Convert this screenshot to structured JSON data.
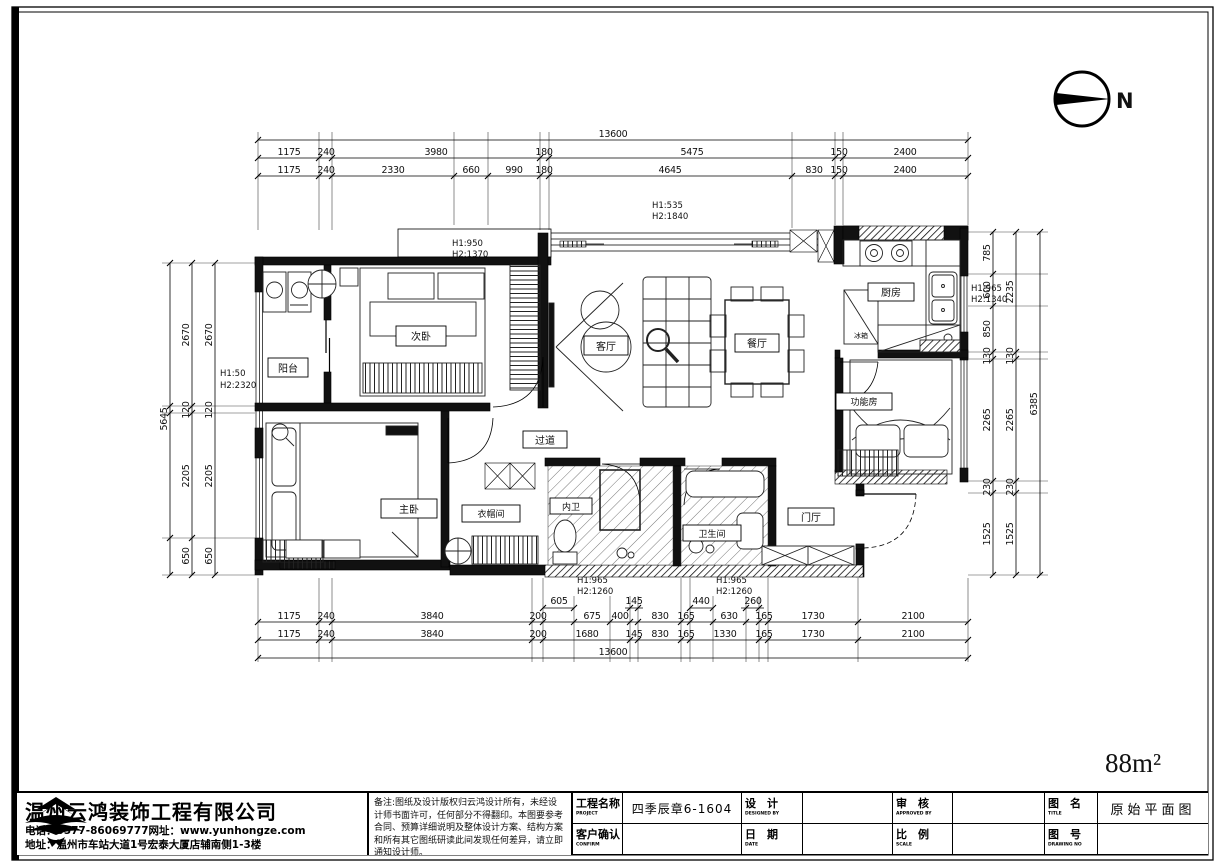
{
  "meta": {
    "area_label": "88m²",
    "north_label": "N"
  },
  "rooms": {
    "balcony": "阳台",
    "bedroom2": "次卧",
    "living": "客厅",
    "dining": "餐厅",
    "kitchen": "厨房",
    "fridge": "冰箱",
    "function_room": "功能房",
    "corridor": "过道",
    "master": "主卧",
    "cloakroom": "衣帽间",
    "master_bath": "内卫",
    "bathroom": "卫生间",
    "foyer": "门厅"
  },
  "h_notes": {
    "top_center": {
      "l1": "H1:535",
      "l2": "H2:1840"
    },
    "bed2_bay": {
      "l1": "H1:950",
      "l2": "H2:1370"
    },
    "left_wall": {
      "l1": "H1:50",
      "l2": "H2:2320"
    },
    "kitchen_win": {
      "l1": "H1:965",
      "l2": "H2:1340"
    },
    "bottom_a": {
      "l1": "H1:965",
      "l2": "H2:1260"
    },
    "bottom_b": {
      "l1": "H1:965",
      "l2": "H2:1260"
    }
  },
  "dims": {
    "top_total": "13600",
    "top_row2": [
      "1175",
      "240",
      "3980",
      "180",
      "5475",
      "150",
      "2400"
    ],
    "top_row3": [
      "1175",
      "240",
      "2330",
      "660",
      "990",
      "180",
      "4645",
      "830",
      "150",
      "2400"
    ],
    "bottom_raised": [
      "605",
      "145",
      "440",
      "260"
    ],
    "bottom_row1": [
      "1175",
      "240",
      "3840",
      "200",
      "675",
      "400",
      "830",
      "165",
      "630",
      "165",
      "1730",
      "2100"
    ],
    "bottom_row2": [
      "1175",
      "240",
      "3840",
      "200",
      "1680",
      "145",
      "830",
      "165",
      "1330",
      "165",
      "1730",
      "2100"
    ],
    "bottom_total": "13600",
    "left_col": [
      "2670",
      "120",
      "2205",
      "650"
    ],
    "left_total": "5645",
    "right_col1": [
      "785",
      "600",
      "850",
      "130",
      "2265",
      "230",
      "1525"
    ],
    "right_col2": [
      "2235",
      "130",
      "2265",
      "230",
      "1525"
    ],
    "right_total": "6385"
  },
  "titleblock": {
    "company": "温州云鸿装饰工程有限公司",
    "contact_phone": "电话：0577-86069777网址：www.yunhongze.com",
    "contact_addr": "地址：温州市车站大道1号宏泰大厦店辅南侧1-3楼",
    "notes": "备注:图纸及设计版权归云鸿设计所有，未经设计师书面许可，任何部分不得翻印。本图要参考合同、预算详细说明及整体设计方案、结构方案和所有其它图纸研读此间发现任何差异，请立即通知设计师。",
    "project_label": "工程名称",
    "project_label_en": "PROJECT",
    "project_value": "四季辰章6-1604",
    "confirm_label": "客户确认",
    "confirm_label_en": "CONFIRM",
    "design_label": "设　计",
    "design_label_en": "DESIGNED BY",
    "date_label": "日　期",
    "date_label_en": "DATE",
    "approve_label": "审　核",
    "approve_label_en": "APPROVED BY",
    "scale_label": "比　例",
    "scale_label_en": "SCALE",
    "titlename_label": "图　名",
    "titlename_label_en": "TITLE",
    "drawno_label": "图　号",
    "drawno_label_en": "DRAWING NO",
    "title_value": "原始平面图",
    "design_value": "",
    "date_value": "",
    "approve_value": "",
    "scale_value": "",
    "confirm_value": "",
    "drawno_value": ""
  }
}
